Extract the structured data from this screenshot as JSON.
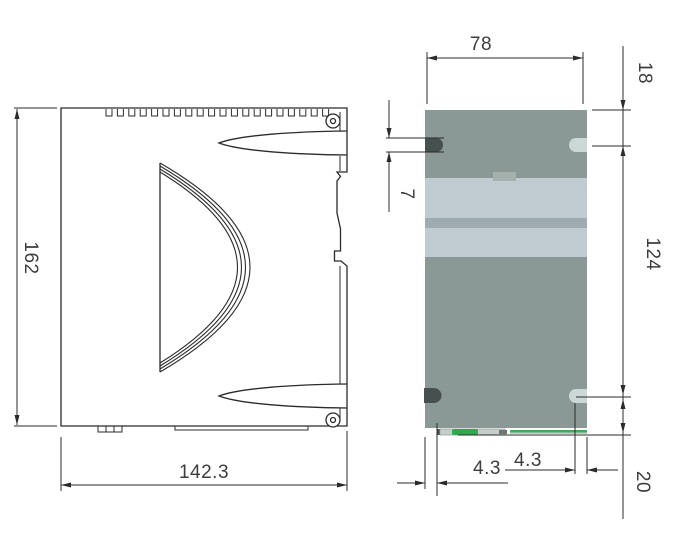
{
  "side_view": {
    "height_label": "162",
    "width_label": "142.3"
  },
  "front_view": {
    "width_label": "78",
    "top_hole_offset_label": "18",
    "hole_spacing_label": "124",
    "bottom_hole_offset_label": "20",
    "slot_height_label": "7",
    "left_hole_inset_label": "4.3",
    "right_hole_inset_label": "4.3"
  },
  "colors": {
    "line": "#2b2b2b",
    "dim_text": "#3d3d3d",
    "body_main": "#8a9995",
    "body_light_band": "#bfcbd0",
    "body_mid_band": "#9eacb1",
    "center_tab": "#a3b0ac",
    "slot_dark": "#46514f",
    "slot_light": "#cbd8d6",
    "connector_grey": "#c6ceca",
    "tick_grey": "#6b7673",
    "green_block": "#2ea94c",
    "green_line": "#44a65f"
  }
}
